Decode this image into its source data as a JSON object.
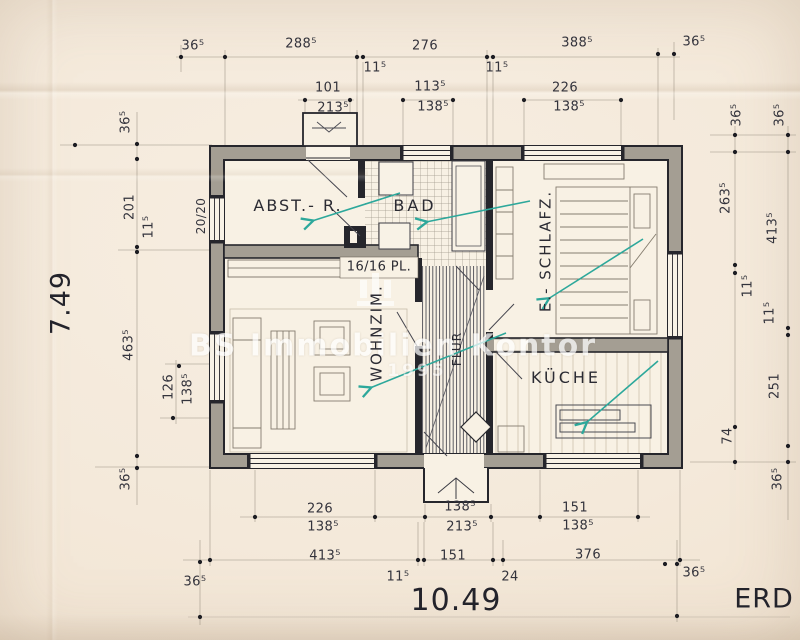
{
  "plan": {
    "floor": "ERD",
    "total_width_m": "10.49",
    "total_height_m": "7.49",
    "rooms": [
      "ABST.- R.",
      "BAD",
      "E.- SCHLAFZ.",
      "WOHNZIM.",
      "KÜCHE",
      "FLUR"
    ],
    "notes": [
      "16/16 PL.",
      "20/20"
    ]
  },
  "watermark": {
    "text": "BS Immobilien Kontor",
    "year": "1995"
  },
  "colors": {
    "paper": "#f4e9da",
    "ink": "#2c2c34",
    "wall_fill": "#a49e93",
    "annotation_teal": "#2da89b",
    "watermark": "#ffffff"
  },
  "labels": [
    {
      "n": "dim-roof-overhang-top-left",
      "t": "36⁵",
      "x": 193,
      "y": 46
    },
    {
      "n": "dim-top-288-5",
      "t": "288⁵",
      "x": 301,
      "y": 44
    },
    {
      "n": "dim-top-11-5-left",
      "t": "11⁵",
      "x": 375,
      "y": 68
    },
    {
      "n": "dim-top-276",
      "t": "276",
      "x": 425,
      "y": 46
    },
    {
      "n": "dim-top-11-5-right",
      "t": "11⁵",
      "x": 497,
      "y": 68
    },
    {
      "n": "dim-top-388-5",
      "t": "388⁵",
      "x": 577,
      "y": 43
    },
    {
      "n": "dim-roof-overhang-top-right",
      "t": "36⁵",
      "x": 694,
      "y": 42
    },
    {
      "n": "dim-porch-101",
      "t": "101",
      "x": 328,
      "y": 88
    },
    {
      "n": "dim-porch-213-5",
      "t": "213⁵",
      "x": 333,
      "y": 108
    },
    {
      "n": "dim-window-113-5",
      "t": "113⁵",
      "x": 430,
      "y": 87
    },
    {
      "n": "dim-window-138-5-top",
      "t": "138⁵",
      "x": 433,
      "y": 107
    },
    {
      "n": "dim-window-226",
      "t": "226",
      "x": 565,
      "y": 88
    },
    {
      "n": "dim-window-138-5-top-right",
      "t": "138⁵",
      "x": 569,
      "y": 107
    },
    {
      "n": "dim-left-36-5-top",
      "t": "36⁵",
      "x": 126,
      "y": 122,
      "r": -90
    },
    {
      "n": "dim-left-201",
      "t": "201",
      "x": 130,
      "y": 207,
      "r": -90
    },
    {
      "n": "dim-left-11-5",
      "t": "11⁵",
      "x": 149,
      "y": 227,
      "r": -90
    },
    {
      "n": "dim-total-height-7-49",
      "t": "7.49",
      "x": 61,
      "y": 303,
      "r": -90,
      "fs": 27,
      "cls": "big"
    },
    {
      "n": "dim-left-463-5",
      "t": "463⁵",
      "x": 129,
      "y": 345,
      "r": -90
    },
    {
      "n": "dim-left-126",
      "t": "126",
      "x": 169,
      "y": 387,
      "r": -90
    },
    {
      "n": "dim-left-138-5",
      "t": "138⁵",
      "x": 188,
      "y": 389,
      "r": -90
    },
    {
      "n": "dim-left-36-5-bottom",
      "t": "36⁵",
      "x": 126,
      "y": 479,
      "r": -90
    },
    {
      "n": "note-post-20-20",
      "t": "20/20",
      "x": 201,
      "y": 216,
      "r": -90,
      "fs": 12
    },
    {
      "n": "dim-right-36-5-inner",
      "t": "36⁵",
      "x": 737,
      "y": 115,
      "r": -90
    },
    {
      "n": "dim-right-36-5-outer",
      "t": "36⁵",
      "x": 780,
      "y": 115,
      "r": -90
    },
    {
      "n": "dim-right-263-5",
      "t": "263⁵",
      "x": 726,
      "y": 198,
      "r": -90
    },
    {
      "n": "dim-right-413-5",
      "t": "413⁵",
      "x": 773,
      "y": 228,
      "r": -90
    },
    {
      "n": "dim-right-11-5-inner",
      "t": "11⁵",
      "x": 748,
      "y": 286,
      "r": -90
    },
    {
      "n": "dim-right-11-5-outer",
      "t": "11⁵",
      "x": 770,
      "y": 313,
      "r": -90
    },
    {
      "n": "dim-right-251",
      "t": "251",
      "x": 775,
      "y": 386,
      "r": -90
    },
    {
      "n": "dim-right-74",
      "t": "74",
      "x": 728,
      "y": 436,
      "r": -90
    },
    {
      "n": "dim-right-36-5-bottom",
      "t": "36⁵",
      "x": 778,
      "y": 479,
      "r": -90
    },
    {
      "n": "dim-bottom-226",
      "t": "226",
      "x": 320,
      "y": 509
    },
    {
      "n": "dim-bottom-138-5-left",
      "t": "138⁵",
      "x": 323,
      "y": 527
    },
    {
      "n": "dim-bottom-138-5-center",
      "t": "138⁵",
      "x": 460,
      "y": 507
    },
    {
      "n": "dim-bottom-213-5",
      "t": "213⁵",
      "x": 462,
      "y": 527
    },
    {
      "n": "dim-bottom-151-right",
      "t": "151",
      "x": 575,
      "y": 508
    },
    {
      "n": "dim-bottom-138-5-right",
      "t": "138⁵",
      "x": 578,
      "y": 526
    },
    {
      "n": "dim-bottom-413-5",
      "t": "413⁵",
      "x": 325,
      "y": 556
    },
    {
      "n": "dim-bottom-11-5",
      "t": "11⁵",
      "x": 398,
      "y": 577
    },
    {
      "n": "dim-bottom-151-center",
      "t": "151",
      "x": 453,
      "y": 556
    },
    {
      "n": "dim-bottom-24",
      "t": "24",
      "x": 510,
      "y": 577
    },
    {
      "n": "dim-bottom-376",
      "t": "376",
      "x": 588,
      "y": 555
    },
    {
      "n": "dim-bottom-36-5-left",
      "t": "36⁵",
      "x": 195,
      "y": 582
    },
    {
      "n": "dim-bottom-36-5-right",
      "t": "36⁵",
      "x": 694,
      "y": 573
    },
    {
      "n": "dim-total-width-10-49",
      "t": "10.49",
      "x": 456,
      "y": 601,
      "fs": 30,
      "cls": "big"
    },
    {
      "n": "floor-label-erd",
      "t": "ERD",
      "x": 764,
      "y": 599,
      "fs": 27,
      "cls": "big"
    },
    {
      "n": "room-label-abstellraum",
      "t": "ABST.- R.",
      "x": 298,
      "y": 206,
      "fs": 16,
      "ls": 2,
      "cls": "room"
    },
    {
      "n": "room-label-bad",
      "t": "BAD",
      "x": 415,
      "y": 206,
      "fs": 16,
      "ls": 3,
      "cls": "room"
    },
    {
      "n": "note-beam-16-16",
      "t": "16/16 PL.",
      "x": 379,
      "y": 267,
      "fs": 13,
      "cls": "room"
    },
    {
      "n": "room-label-schlafzimmer",
      "t": "E.- SCHLAFZ.",
      "x": 546,
      "y": 251,
      "r": -90,
      "fs": 15,
      "ls": 2,
      "cls": "room"
    },
    {
      "n": "room-label-wohnzimmer",
      "t": "WOHNZIM.",
      "x": 377,
      "y": 333,
      "r": -90,
      "fs": 15,
      "ls": 2,
      "cls": "room"
    },
    {
      "n": "room-label-flur",
      "t": "FLUR",
      "x": 457,
      "y": 349,
      "r": -90,
      "fs": 12,
      "ls": 1,
      "cls": "room"
    },
    {
      "n": "room-label-kueche",
      "t": "KÜCHE",
      "x": 566,
      "y": 378,
      "fs": 16,
      "ls": 3,
      "cls": "room"
    }
  ]
}
